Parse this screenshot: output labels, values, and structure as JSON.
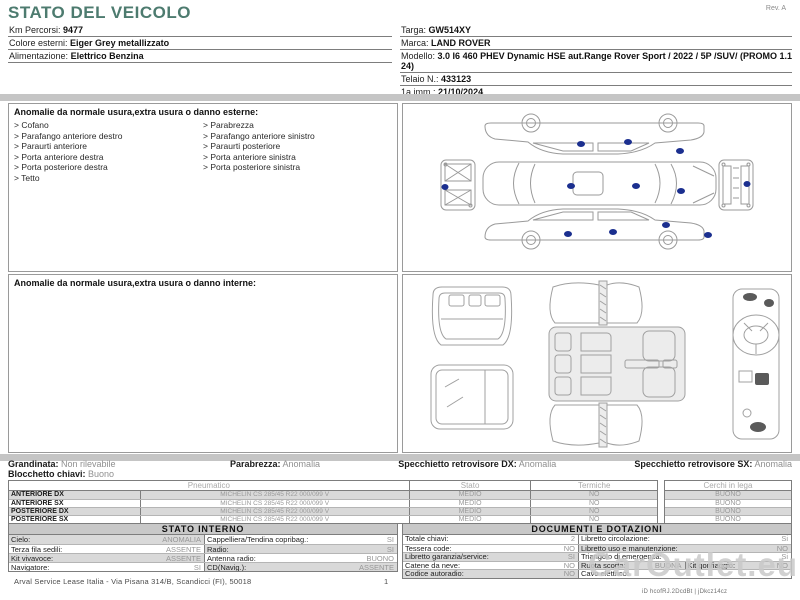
{
  "page": {
    "title": "STATO DEL VEICOLO",
    "revision": "Rev. A"
  },
  "vehicle_info": {
    "left": [
      {
        "label": "Km Percorsi:",
        "value": "9477"
      },
      {
        "label": "Colore esterni:",
        "value": "Eiger Grey metallizzato"
      },
      {
        "label": "Alimentazione:",
        "value": "Elettrico Benzina"
      }
    ],
    "right": [
      {
        "label": "Targa:",
        "value": "GW514XY"
      },
      {
        "label": "Marca:",
        "value": "LAND ROVER"
      },
      {
        "label": "Modello:",
        "value": "3.0 I6 460 PHEV Dynamic HSE aut.Range Rover Sport / 2022 / 5P /SUV/ (PROMO 1.1 24)"
      },
      {
        "label": "Telaio N.:",
        "value": "433123"
      },
      {
        "label": "1a imm.:",
        "value": "21/10/2024"
      }
    ]
  },
  "damage_external": {
    "title": "Anomalie da normale usura,extra usura o danno esterne:",
    "col1": [
      "Cofano",
      "Parafango anteriore destro",
      "Paraurti anteriore",
      "Porta anteriore destra",
      "Porta posteriore destra",
      "Tetto"
    ],
    "col2": [
      "Parabrezza",
      "Parafango anteriore sinistro",
      "Paraurti posteriore",
      "Porta anteriore sinistra",
      "Porta posteriore sinistra"
    ]
  },
  "damage_internal": {
    "title": "Anomalie da normale usura,extra usura o danno interne:"
  },
  "condition_summary": {
    "grandinata": {
      "label": "Grandinata:",
      "value": "Non rilevabile"
    },
    "blocchetto": {
      "label": "Blocchetto chiavi:",
      "value": "Buono"
    },
    "parabrezza": {
      "label": "Parabrezza:",
      "value": "Anomalia"
    },
    "specchietto_dx": {
      "label": "Specchietto retrovisore DX:",
      "value": "Anomalia"
    },
    "specchietto_sx": {
      "label": "Specchietto retrovisore SX:",
      "value": "Anomalia"
    }
  },
  "tyre_table": {
    "headers": {
      "pneumatico": "Pneumatico",
      "stato": "Stato",
      "termiche": "Termiche",
      "cerchi": "Cerchi in lega"
    },
    "rows": [
      {
        "position": "ANTERIORE DX",
        "tyre": "MICHELIN CS 285/45 R22 000/099 V",
        "stato": "MEDIO",
        "termiche": "NO",
        "cerchi": "BUONO"
      },
      {
        "position": "ANTERIORE SX",
        "tyre": "MICHELIN CS 285/45 R22 000/099 V",
        "stato": "MEDIO",
        "termiche": "NO",
        "cerchi": "BUONO"
      },
      {
        "position": "POSTERIORE DX",
        "tyre": "MICHELIN CS 285/45 R22 000/099 V",
        "stato": "MEDIO",
        "termiche": "NO",
        "cerchi": "BUONO"
      },
      {
        "position": "POSTERIORE SX",
        "tyre": "MICHELIN CS 285/45 R22 000/099 V",
        "stato": "MEDIO",
        "termiche": "NO",
        "cerchi": "BUONO"
      }
    ]
  },
  "stato_interno": {
    "title": "STATO INTERNO",
    "rows": [
      {
        "l_label": "Cielo:",
        "l_value": "ANOMALIA",
        "r_label": "Cappelliera/Tendina copribag.:",
        "r_value": "SI"
      },
      {
        "l_label": "Terza fila sedili:",
        "l_value": "ASSENTE",
        "r_label": "Radio:",
        "r_value": "SI"
      },
      {
        "l_label": "Kit vivavoce:",
        "l_value": "ASSENTE",
        "r_label": "Antenna radio:",
        "r_value": "BUONO"
      },
      {
        "l_label": "Navigatore:",
        "l_value": "SI",
        "r_label": "CD(Navig.):",
        "r_value": "ASSENTE"
      }
    ]
  },
  "documenti": {
    "title": "DOCUMENTI E DOTAZIONI",
    "rows": [
      {
        "l_label": "Totale chiavi:",
        "l_value": "2",
        "r_label": "Libretto circolazione:",
        "r_value": "Si"
      },
      {
        "l_label": "Tessera code:",
        "l_value": "NO",
        "r_label": "Libretto uso e manutenzione:",
        "r_value": "NO"
      },
      {
        "l_label": "Libretto garanzia/service:",
        "l_value": "SI",
        "r_label": "Triangolo di emergenza:",
        "r_value": "Si"
      },
      {
        "l_label": "Catene da neve:",
        "l_value": "NO",
        "r_label": "Ruota scorta:",
        "r_value": "BUONA",
        "r2_label": "Kit gonfiaggio:",
        "r2_value": "NO"
      },
      {
        "l_label": "Codice autoradio:",
        "l_value": "NO",
        "r_label": "Cavo elettrico:",
        "r_value": ""
      }
    ]
  },
  "footer": {
    "company": "Arval Service Lease Italia - Via Pisana 314/B, Scandicci (FI), 50018",
    "page": "1",
    "watermark": "CarOutlet.eu",
    "doc_id": "iD hcofRJ.2DcdBt | jDkcz14cz"
  },
  "colors": {
    "accent_teal": "#4d7b6f",
    "damage_dot_blue": "#1b2f8f",
    "stripe_gray": "#d9d9d9",
    "bar_gray": "#c5c5c5"
  }
}
